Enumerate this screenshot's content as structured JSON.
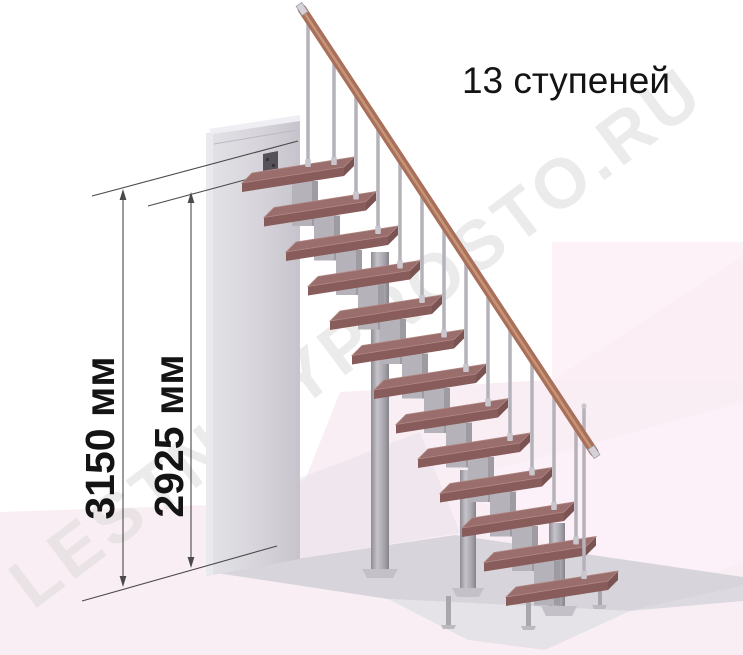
{
  "figure": {
    "title": "13 ступеней",
    "watermark": "LESTNICYPROSTO.RU",
    "dimensions": [
      {
        "id": "total-height",
        "label": "3150 мм",
        "value": 3150,
        "unit": "мм"
      },
      {
        "id": "flight-height",
        "label": "2925 мм",
        "value": 2925,
        "unit": "мм"
      }
    ],
    "stair": {
      "steps_count": 13
    },
    "colors": {
      "ink": "#141414",
      "dimension_line": "#4a4a4a",
      "watermark_gray": "#d9d9d9",
      "tread_top": "#9a6e6c",
      "tread_top_edge": "#b18985",
      "tread_front": "#875c5b",
      "tread_side": "#7a5352",
      "handrail": "#a8705a",
      "handrail_highlight": "#cd9b7e",
      "metal": "#b5b2b9",
      "metal_dark": "#94919a",
      "metal_cap": "#c9c6cd",
      "wall_light": "#e6e5ea",
      "wall_dark": "#cdcad2",
      "floor_pink": "#faeef5",
      "corner_pink": "#fdf2f7",
      "corner_pink_facet": "#fbeef4",
      "slab_top": "#d7d5db",
      "slab_front": "#e5e3e8",
      "background": "#ffffff"
    }
  }
}
